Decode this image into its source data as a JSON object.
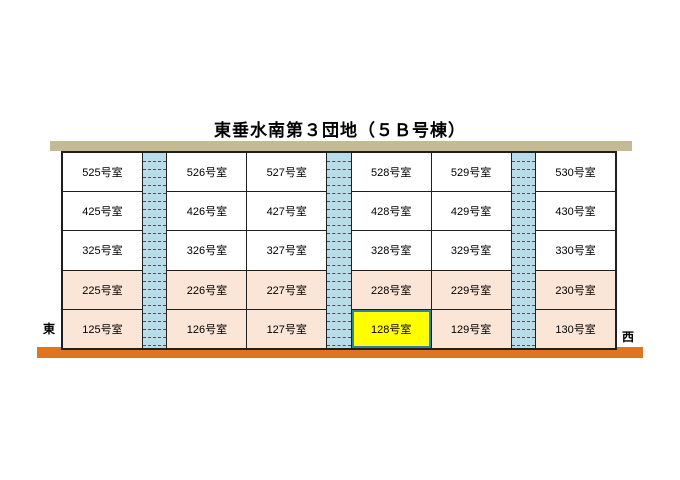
{
  "title": "東垂水南第３団地（５Ｂ号棟）",
  "direction_labels": {
    "left": "東",
    "right": "西"
  },
  "floors": [
    {
      "level": 5,
      "shaded": false,
      "rooms": [
        "525号室",
        "526号室",
        "527号室",
        "528号室",
        "529号室",
        "530号室"
      ]
    },
    {
      "level": 4,
      "shaded": false,
      "rooms": [
        "425号室",
        "426号室",
        "427号室",
        "428号室",
        "429号室",
        "430号室"
      ]
    },
    {
      "level": 3,
      "shaded": false,
      "rooms": [
        "325号室",
        "326号室",
        "327号室",
        "328号室",
        "329号室",
        "330号室"
      ]
    },
    {
      "level": 2,
      "shaded": true,
      "rooms": [
        "225号室",
        "226号室",
        "227号室",
        "228号室",
        "229号室",
        "230号室"
      ]
    },
    {
      "level": 1,
      "shaded": true,
      "rooms": [
        "125号室",
        "126号室",
        "127号室",
        "128号室",
        "129号室",
        "130号室"
      ]
    }
  ],
  "highlighted_room": "128号室",
  "colors": {
    "roof": "#c4bb94",
    "ground": "#e0751e",
    "stairwell": "#b8dce9",
    "upper_floor_bg": "#ffffff",
    "lower_floor_bg": "#fbe5d6",
    "highlight_bg": "#ffff00",
    "highlight_border": "#31849b",
    "grid_line": "#1f1f1f"
  }
}
